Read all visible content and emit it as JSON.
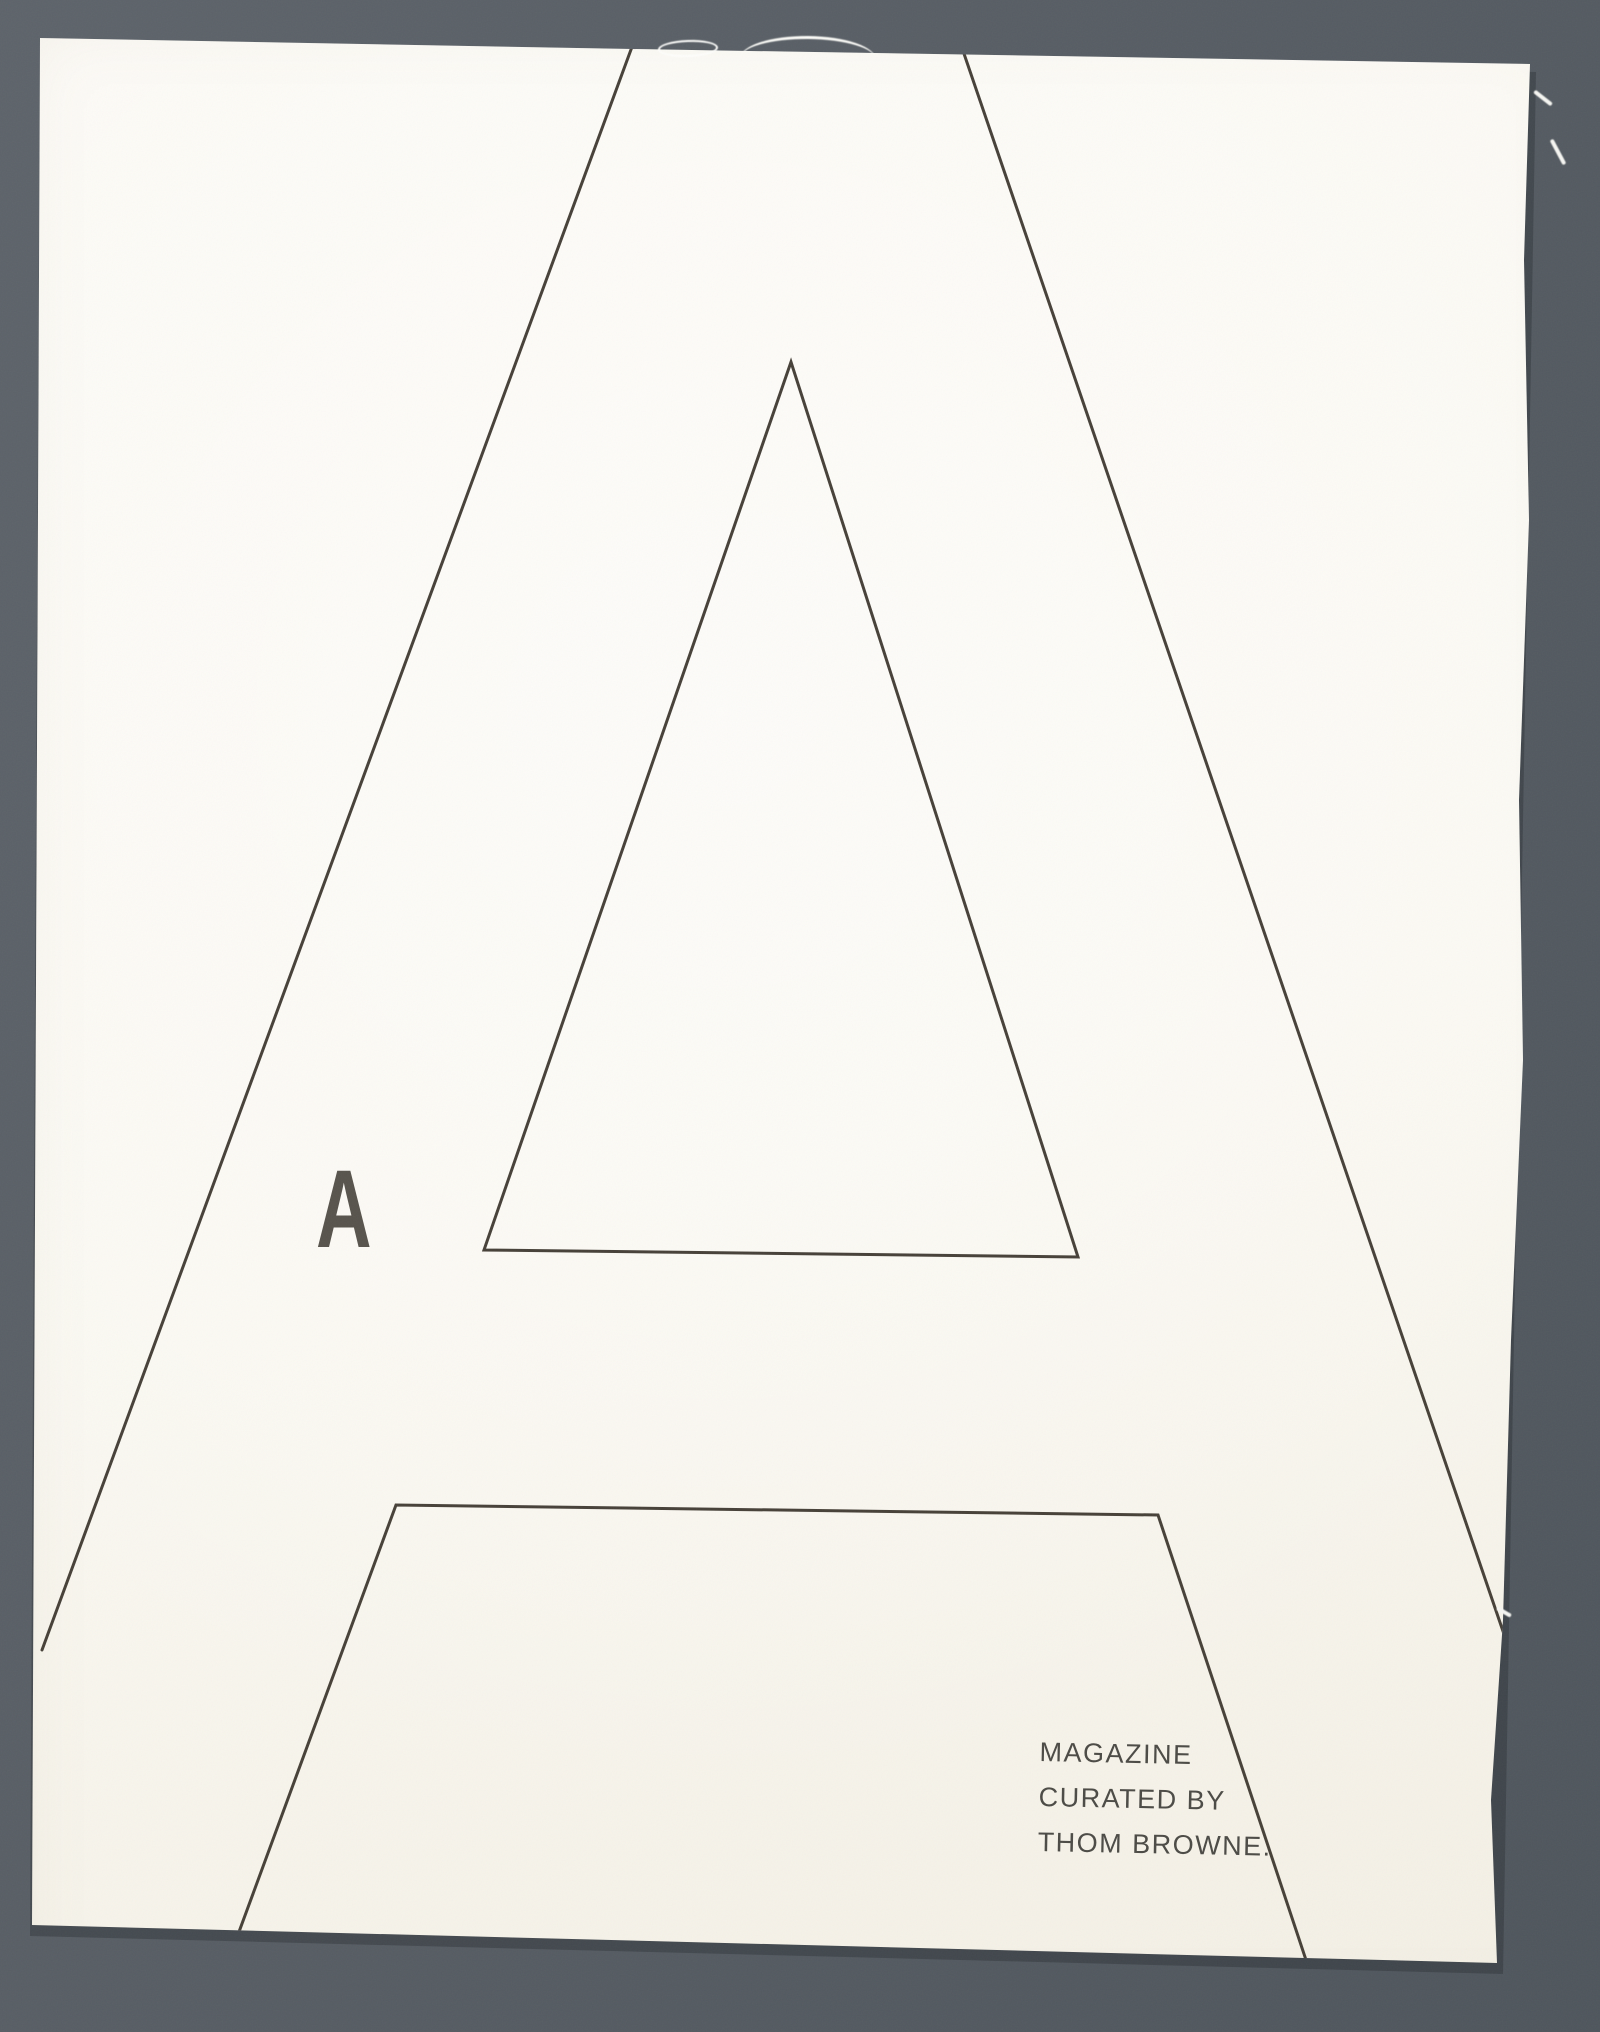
{
  "artwork": {
    "large_letter": "A",
    "small_letter": "A"
  },
  "caption": {
    "lines": [
      "MAGAZINE",
      "CURATED BY",
      "THOM BROWNE."
    ]
  },
  "colors": {
    "mat_background": "#565d64",
    "paper": "#fbf9f3",
    "outline_ink": "#3a342c",
    "small_letter_ink": "#57534c",
    "caption_ink": "#4b4a45"
  }
}
